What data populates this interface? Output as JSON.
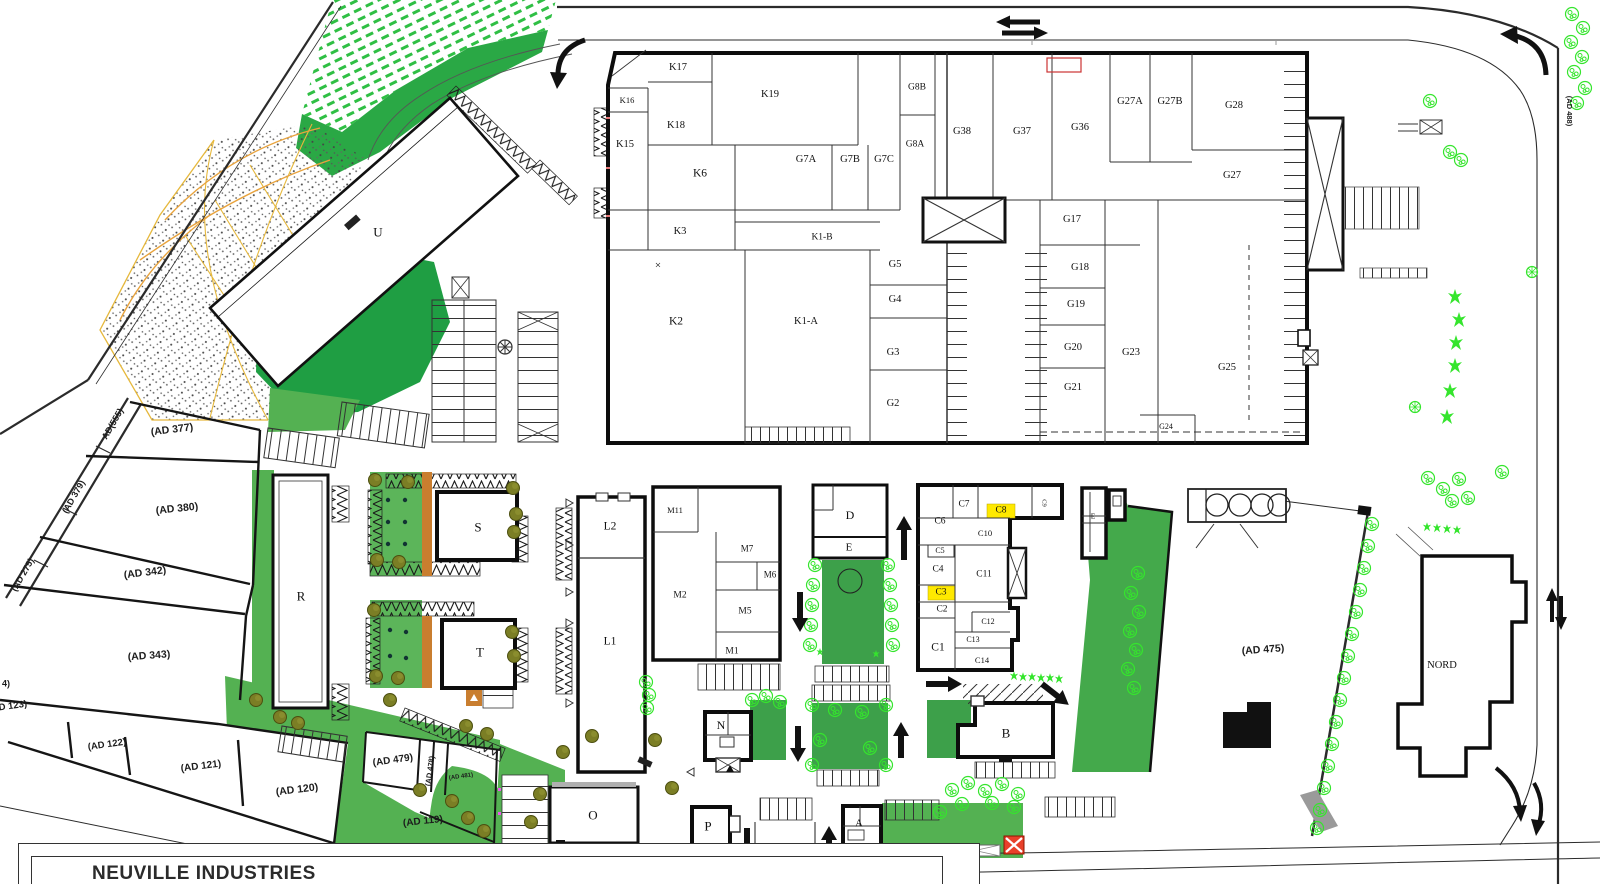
{
  "title_block": {
    "company": "NEUVILLE INDUSTRIES"
  },
  "colors": {
    "green_dark": "#1f9e43",
    "green_mid": "#54b152",
    "green_park": "#3da04a",
    "green_bright": "#35e52d",
    "olive": "#7b7e25",
    "orange_path": "#c97e2f",
    "yellow_highlight": "#ffe900",
    "red_marker": "#e8402a",
    "wall": "#111111"
  },
  "icons": [
    "two-way-traffic-arrows",
    "curved-entry-arrow-top-left",
    "curved-entry-arrow-top-right",
    "curved-exit-arrows-bottom-right",
    "up-arrow",
    "down-arrow",
    "right-arrow",
    "diagonal-arrow",
    "double-vertical-arrow",
    "red-x-marker",
    "tree-bush-icon",
    "tree-olive-icon",
    "star-tree-icon",
    "crosshatch-box"
  ],
  "plan": {
    "labels": [
      {
        "t": "K17",
        "x": 678,
        "y": 68,
        "k": "room"
      },
      {
        "t": "K16",
        "x": 627,
        "y": 100,
        "fs": 8.5,
        "k": "room"
      },
      {
        "t": "K19",
        "x": 770,
        "y": 95,
        "k": "room"
      },
      {
        "t": "K18",
        "x": 676,
        "y": 126,
        "k": "room"
      },
      {
        "t": "K15",
        "x": 625,
        "y": 145,
        "k": "room"
      },
      {
        "t": "K6",
        "x": 700,
        "y": 174,
        "fs": 11.5,
        "k": "room"
      },
      {
        "t": "G7A",
        "x": 806,
        "y": 160,
        "k": "room"
      },
      {
        "t": "G7B",
        "x": 850,
        "y": 160,
        "k": "room"
      },
      {
        "t": "G7C",
        "x": 884,
        "y": 160,
        "k": "room"
      },
      {
        "t": "G8B",
        "x": 917,
        "y": 88,
        "fs": 9.5,
        "k": "room"
      },
      {
        "t": "G8A",
        "x": 915,
        "y": 145,
        "fs": 9.5,
        "k": "room"
      },
      {
        "t": "G38",
        "x": 962,
        "y": 132,
        "k": "room"
      },
      {
        "t": "G37",
        "x": 1022,
        "y": 132,
        "k": "room"
      },
      {
        "t": "G36",
        "x": 1080,
        "y": 128,
        "k": "room"
      },
      {
        "t": "G27A",
        "x": 1130,
        "y": 102,
        "k": "room"
      },
      {
        "t": "G27B",
        "x": 1170,
        "y": 102,
        "k": "room"
      },
      {
        "t": "G28",
        "x": 1234,
        "y": 106,
        "k": "room"
      },
      {
        "t": "G27",
        "x": 1232,
        "y": 176,
        "k": "room"
      },
      {
        "t": "K3",
        "x": 680,
        "y": 232,
        "k": "room"
      },
      {
        "t": "K1-B",
        "x": 822,
        "y": 238,
        "fs": 9.5,
        "k": "room"
      },
      {
        "t": "G17",
        "x": 1072,
        "y": 220,
        "k": "room"
      },
      {
        "t": "G5",
        "x": 895,
        "y": 265,
        "k": "room"
      },
      {
        "t": "G18",
        "x": 1080,
        "y": 268,
        "k": "room"
      },
      {
        "t": "K2",
        "x": 676,
        "y": 322,
        "fs": 11.5,
        "k": "room"
      },
      {
        "t": "K1-A",
        "x": 806,
        "y": 322,
        "fs": 10.5,
        "k": "room"
      },
      {
        "t": "G4",
        "x": 895,
        "y": 300,
        "k": "room"
      },
      {
        "t": "G19",
        "x": 1076,
        "y": 305,
        "k": "room"
      },
      {
        "t": "G3",
        "x": 893,
        "y": 353,
        "k": "room"
      },
      {
        "t": "G20",
        "x": 1073,
        "y": 348,
        "k": "room"
      },
      {
        "t": "G23",
        "x": 1131,
        "y": 353,
        "k": "room"
      },
      {
        "t": "G25",
        "x": 1227,
        "y": 368,
        "k": "room"
      },
      {
        "t": "G2",
        "x": 893,
        "y": 404,
        "k": "room"
      },
      {
        "t": "G21",
        "x": 1073,
        "y": 388,
        "k": "room"
      },
      {
        "t": "G24",
        "x": 1166,
        "y": 427,
        "fs": 8,
        "k": "room"
      },
      {
        "t": "×",
        "x": 658,
        "y": 266,
        "fs": 11,
        "k": "mark"
      },
      {
        "t": "U",
        "x": 378,
        "y": 232,
        "fs": 13,
        "k": "building"
      },
      {
        "t": "R",
        "x": 301,
        "y": 596,
        "fs": 13,
        "k": "building"
      },
      {
        "t": "S",
        "x": 478,
        "y": 527,
        "fs": 13,
        "k": "building"
      },
      {
        "t": "T",
        "x": 480,
        "y": 652,
        "fs": 13,
        "k": "building"
      },
      {
        "t": "L2",
        "x": 610,
        "y": 527,
        "fs": 11.5,
        "k": "building"
      },
      {
        "t": "L1",
        "x": 610,
        "y": 642,
        "fs": 11.5,
        "k": "building"
      },
      {
        "t": "M11",
        "x": 675,
        "y": 510,
        "fs": 8.5,
        "k": "room"
      },
      {
        "t": "M7",
        "x": 747,
        "y": 549,
        "fs": 9,
        "k": "room"
      },
      {
        "t": "M6",
        "x": 770,
        "y": 575,
        "fs": 9,
        "k": "room"
      },
      {
        "t": "M2",
        "x": 680,
        "y": 596,
        "fs": 9.5,
        "k": "room"
      },
      {
        "t": "M5",
        "x": 745,
        "y": 612,
        "fs": 9.5,
        "k": "room"
      },
      {
        "t": "M1",
        "x": 732,
        "y": 652,
        "fs": 9.5,
        "k": "room"
      },
      {
        "t": "D",
        "x": 850,
        "y": 515,
        "fs": 12,
        "k": "building"
      },
      {
        "t": "E",
        "x": 849,
        "y": 548,
        "fs": 11,
        "k": "building"
      },
      {
        "t": "C6",
        "x": 940,
        "y": 522,
        "fs": 9.5,
        "k": "room"
      },
      {
        "t": "C7",
        "x": 964,
        "y": 505,
        "fs": 9.5,
        "k": "room"
      },
      {
        "t": "C8",
        "x": 1001,
        "y": 511,
        "fs": 9.5,
        "k": "room"
      },
      {
        "t": "C9",
        "x": 1043,
        "y": 503,
        "fs": 6.5,
        "r": 90,
        "k": "room"
      },
      {
        "t": "C10",
        "x": 985,
        "y": 533,
        "fs": 8.5,
        "k": "room"
      },
      {
        "t": "C5",
        "x": 940,
        "y": 551,
        "fs": 8,
        "k": "room"
      },
      {
        "t": "C4",
        "x": 938,
        "y": 570,
        "fs": 9.5,
        "k": "room"
      },
      {
        "t": "C11",
        "x": 984,
        "y": 575,
        "fs": 9.5,
        "k": "room"
      },
      {
        "t": "C3",
        "x": 941,
        "y": 593,
        "fs": 9.5,
        "k": "room"
      },
      {
        "t": "C2",
        "x": 942,
        "y": 610,
        "fs": 9.5,
        "k": "room"
      },
      {
        "t": "C12",
        "x": 988,
        "y": 622,
        "fs": 8,
        "k": "room"
      },
      {
        "t": "C13",
        "x": 973,
        "y": 640,
        "fs": 8,
        "k": "room"
      },
      {
        "t": "C1",
        "x": 938,
        "y": 648,
        "fs": 11.5,
        "k": "room"
      },
      {
        "t": "C14",
        "x": 982,
        "y": 660,
        "fs": 8.5,
        "k": "room"
      },
      {
        "t": "N",
        "x": 721,
        "y": 725,
        "fs": 12,
        "k": "building"
      },
      {
        "t": "B",
        "x": 1006,
        "y": 733,
        "fs": 13,
        "k": "building"
      },
      {
        "t": "O",
        "x": 593,
        "y": 815,
        "fs": 13,
        "k": "building"
      },
      {
        "t": "P",
        "x": 708,
        "y": 826,
        "fs": 13,
        "k": "building"
      },
      {
        "t": "A",
        "x": 859,
        "y": 824,
        "fs": 11,
        "k": "building"
      },
      {
        "t": "NORD",
        "x": 1442,
        "y": 666,
        "fs": 10.5,
        "k": "building"
      },
      {
        "t": "E",
        "x": 1093,
        "y": 516,
        "fs": 7.5,
        "k": "room"
      },
      {
        "t": "(AD 377)",
        "x": 172,
        "y": 430,
        "fs": 10.5,
        "r": -7,
        "c": "s",
        "k": "parcel"
      },
      {
        "t": "AD(555)",
        "x": 113,
        "y": 424,
        "fs": 9,
        "r": -60,
        "c": "s",
        "k": "parcel"
      },
      {
        "t": "(AD 380)",
        "x": 177,
        "y": 509,
        "fs": 10.5,
        "r": -6,
        "c": "s",
        "k": "parcel"
      },
      {
        "t": "(AD 379)",
        "x": 74,
        "y": 497,
        "fs": 9,
        "r": -60,
        "c": "s",
        "k": "parcel"
      },
      {
        "t": "(AD 342)",
        "x": 145,
        "y": 573,
        "fs": 10.5,
        "r": -7,
        "c": "s",
        "k": "parcel"
      },
      {
        "t": "(AD 275)",
        "x": 23,
        "y": 575,
        "fs": 9,
        "r": -60,
        "c": "s",
        "k": "parcel"
      },
      {
        "t": "(AD 343)",
        "x": 149,
        "y": 656,
        "fs": 10.5,
        "r": -4,
        "c": "s",
        "k": "parcel"
      },
      {
        "t": "4)",
        "x": 6,
        "y": 684,
        "fs": 9,
        "c": "s",
        "k": "parcel"
      },
      {
        "t": "(AD 123)",
        "x": 8,
        "y": 707,
        "fs": 9.5,
        "r": -8,
        "c": "s",
        "k": "parcel"
      },
      {
        "t": "(AD 122)",
        "x": 107,
        "y": 745,
        "fs": 9.5,
        "r": -8,
        "c": "s",
        "k": "parcel"
      },
      {
        "t": "(AD 121)",
        "x": 201,
        "y": 767,
        "fs": 10,
        "r": -7,
        "c": "s",
        "k": "parcel"
      },
      {
        "t": "(AD 120)",
        "x": 297,
        "y": 790,
        "fs": 10.5,
        "r": -7,
        "c": "s",
        "k": "parcel"
      },
      {
        "t": "(AD 479)",
        "x": 393,
        "y": 761,
        "fs": 10,
        "r": -8,
        "c": "s",
        "k": "parcel"
      },
      {
        "t": "(AD 478)",
        "x": 430,
        "y": 771,
        "fs": 7.5,
        "r": -82,
        "c": "s",
        "k": "parcel"
      },
      {
        "t": "(AD 481)",
        "x": 461,
        "y": 777,
        "fs": 6,
        "r": -8,
        "c": "s",
        "k": "parcel"
      },
      {
        "t": "(AD 119)",
        "x": 423,
        "y": 822,
        "fs": 10,
        "r": -6,
        "c": "s",
        "k": "parcel"
      },
      {
        "t": "(AD 475)",
        "x": 1263,
        "y": 650,
        "fs": 10.5,
        "r": -4,
        "c": "s",
        "k": "parcel"
      },
      {
        "t": "(AD 488)",
        "x": 1569,
        "y": 111,
        "fs": 7.5,
        "r": 90,
        "c": "s",
        "k": "parcel"
      }
    ]
  }
}
